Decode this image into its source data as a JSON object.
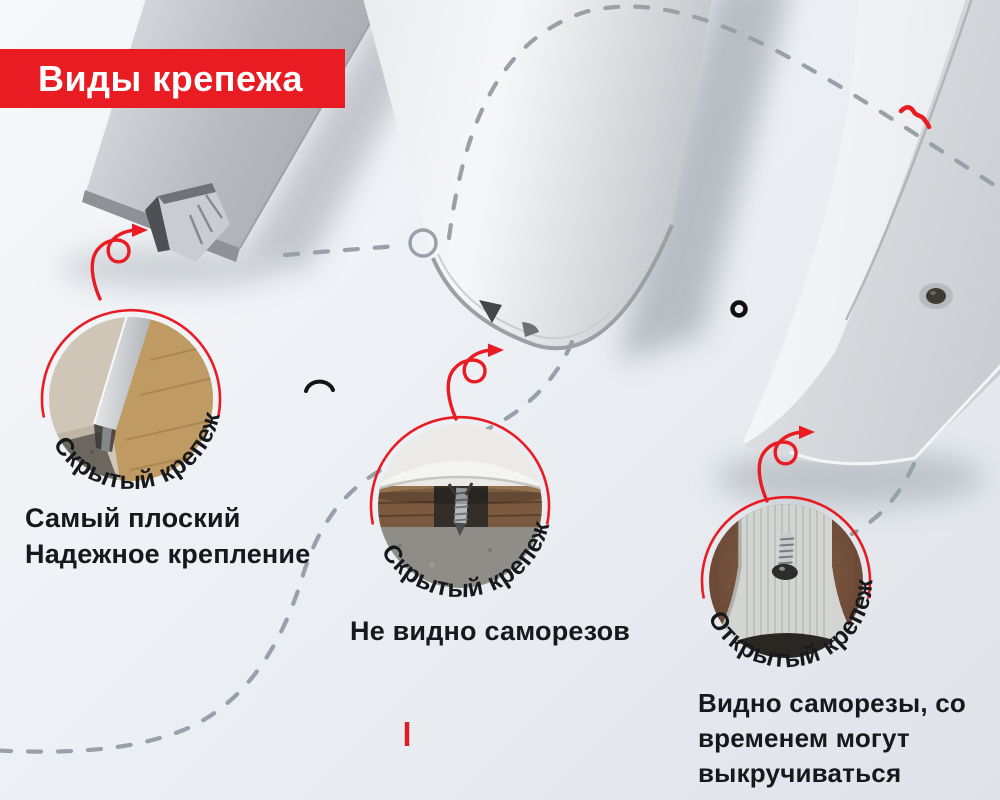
{
  "header": {
    "title": "Виды крепежа"
  },
  "accent_color": "#e91b23",
  "dash_color": "#98a0a8",
  "items": [
    {
      "badge": "Скрытый крепеж",
      "desc_lines": [
        "Самый плоский",
        "Надежное крепление"
      ]
    },
    {
      "badge": "Скрытый крепеж",
      "desc_lines": [
        "Не видно саморезов"
      ]
    },
    {
      "badge": "Открытый крепеж",
      "desc_lines": [
        "Видно саморезы, со",
        "временем могут",
        "выкручиваться"
      ]
    }
  ]
}
